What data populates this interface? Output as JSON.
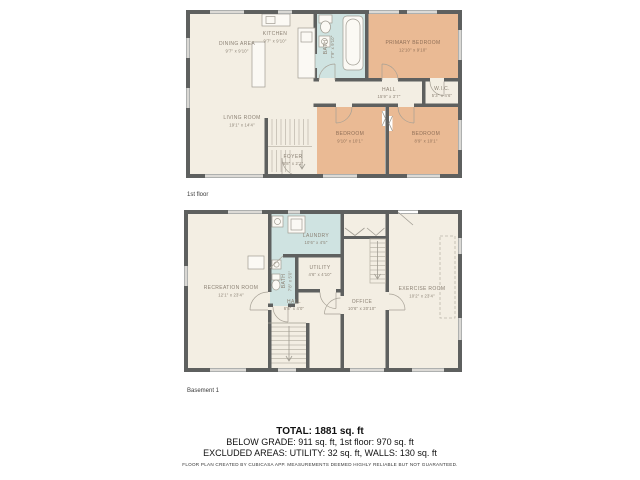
{
  "colors": {
    "wall": "#5e605f",
    "floor": "#f3eee3",
    "room_warm": "#eaba94",
    "room_wet": "#cfe3e1",
    "fixture": "#fbf9f4",
    "fixture_line": "#a09c92",
    "label": "#8b8174",
    "label_warm": "#8f6f57"
  },
  "floor1": {
    "label": "1st floor",
    "rooms": {
      "dining": {
        "name": "DINING AREA",
        "dims": "9'7\" x 9'10\""
      },
      "kitchen": {
        "name": "KITCHEN",
        "dims": "9'7\" x 9'10\""
      },
      "bath": {
        "name": "BATH",
        "dims": "7'9\" x 9'10\""
      },
      "primary": {
        "name": "PRIMARY BEDROOM",
        "dims": "12'10\" x 9'10\""
      },
      "hall": {
        "name": "HALL",
        "dims": "15'9\" x 3'7\""
      },
      "wic": {
        "name": "W.I.C.",
        "dims": "5'3\" x 4'6\""
      },
      "living": {
        "name": "LIVING ROOM",
        "dims": "19'1\" x 14'4\""
      },
      "foyer": {
        "name": "FOYER",
        "dims": "6'8\" x 2'1\""
      },
      "bedroom1": {
        "name": "BEDROOM",
        "dims": "9'10\" x 10'1\""
      },
      "bedroom2": {
        "name": "BEDROOM",
        "dims": "8'9\" x 10'1\""
      }
    }
  },
  "basement": {
    "label": "Basement 1",
    "rooms": {
      "recreation": {
        "name": "RECREATION ROOM",
        "dims": "12'1\" x 23'4\""
      },
      "laundry": {
        "name": "LAUNDRY",
        "dims": "10'6\" x 4'5\""
      },
      "bath": {
        "name": "BATH",
        "dims": "7'8\" x 5'0\""
      },
      "utility": {
        "name": "UTILITY",
        "dims": "4'6\" x 4'10\""
      },
      "hall": {
        "name": "HALL",
        "dims": "6'8\" x 4'0\""
      },
      "office": {
        "name": "OFFICE",
        "dims": "10'6\" x 20'10\""
      },
      "exercise": {
        "name": "EXERCISE ROOM",
        "dims": "10'2\" x 23'4\""
      }
    }
  },
  "summary": {
    "total": "TOTAL: 1881 sq. ft",
    "line2": "BELOW GRADE: 911 sq. ft, 1st floor: 970 sq. ft",
    "line3": "EXCLUDED AREAS: UTILITY: 32 sq. ft, WALLS: 130 sq. ft",
    "disclaimer": "FLOOR PLAN CREATED BY CUBICASA APP. MEASUREMENTS DEEMED HIGHLY RELIABLE BUT NOT GUARANTEED."
  }
}
